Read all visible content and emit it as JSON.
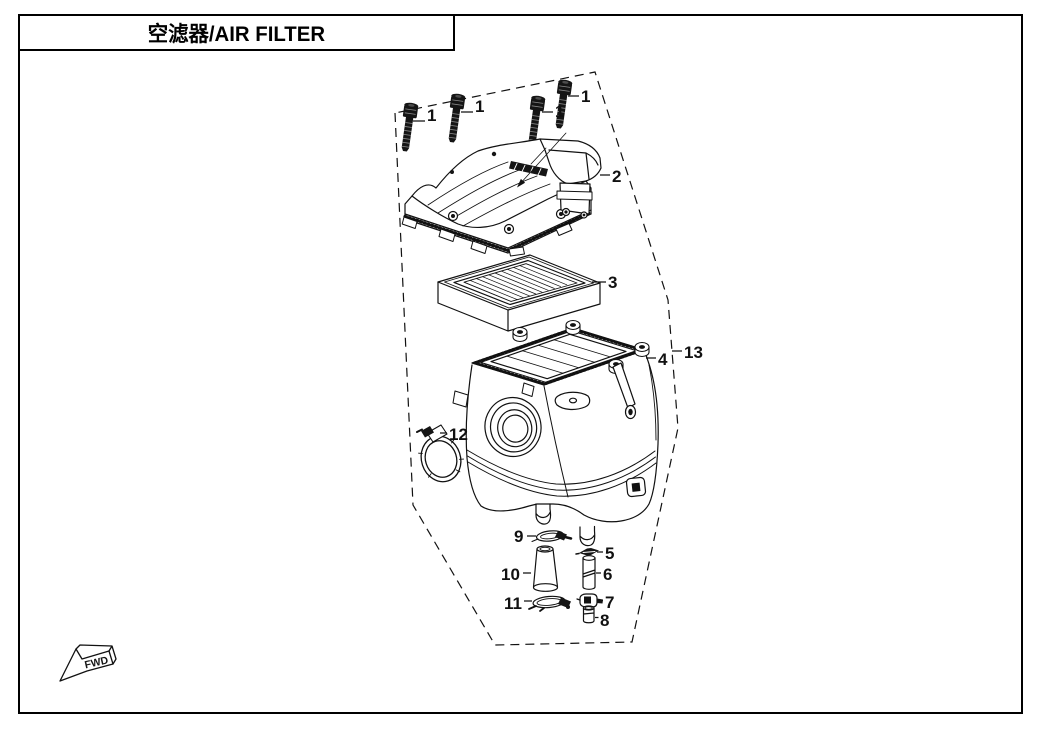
{
  "page": {
    "title": "空滤器/AIR FILTER"
  },
  "colors": {
    "ink": "#111111",
    "paper": "#ffffff"
  },
  "diagram": {
    "fwd_label": "FWD",
    "callouts": [
      "1",
      "1",
      "1",
      "1",
      "2",
      "3",
      "4",
      "13",
      "12",
      "9",
      "5",
      "10",
      "6",
      "11",
      "7",
      "8"
    ]
  }
}
